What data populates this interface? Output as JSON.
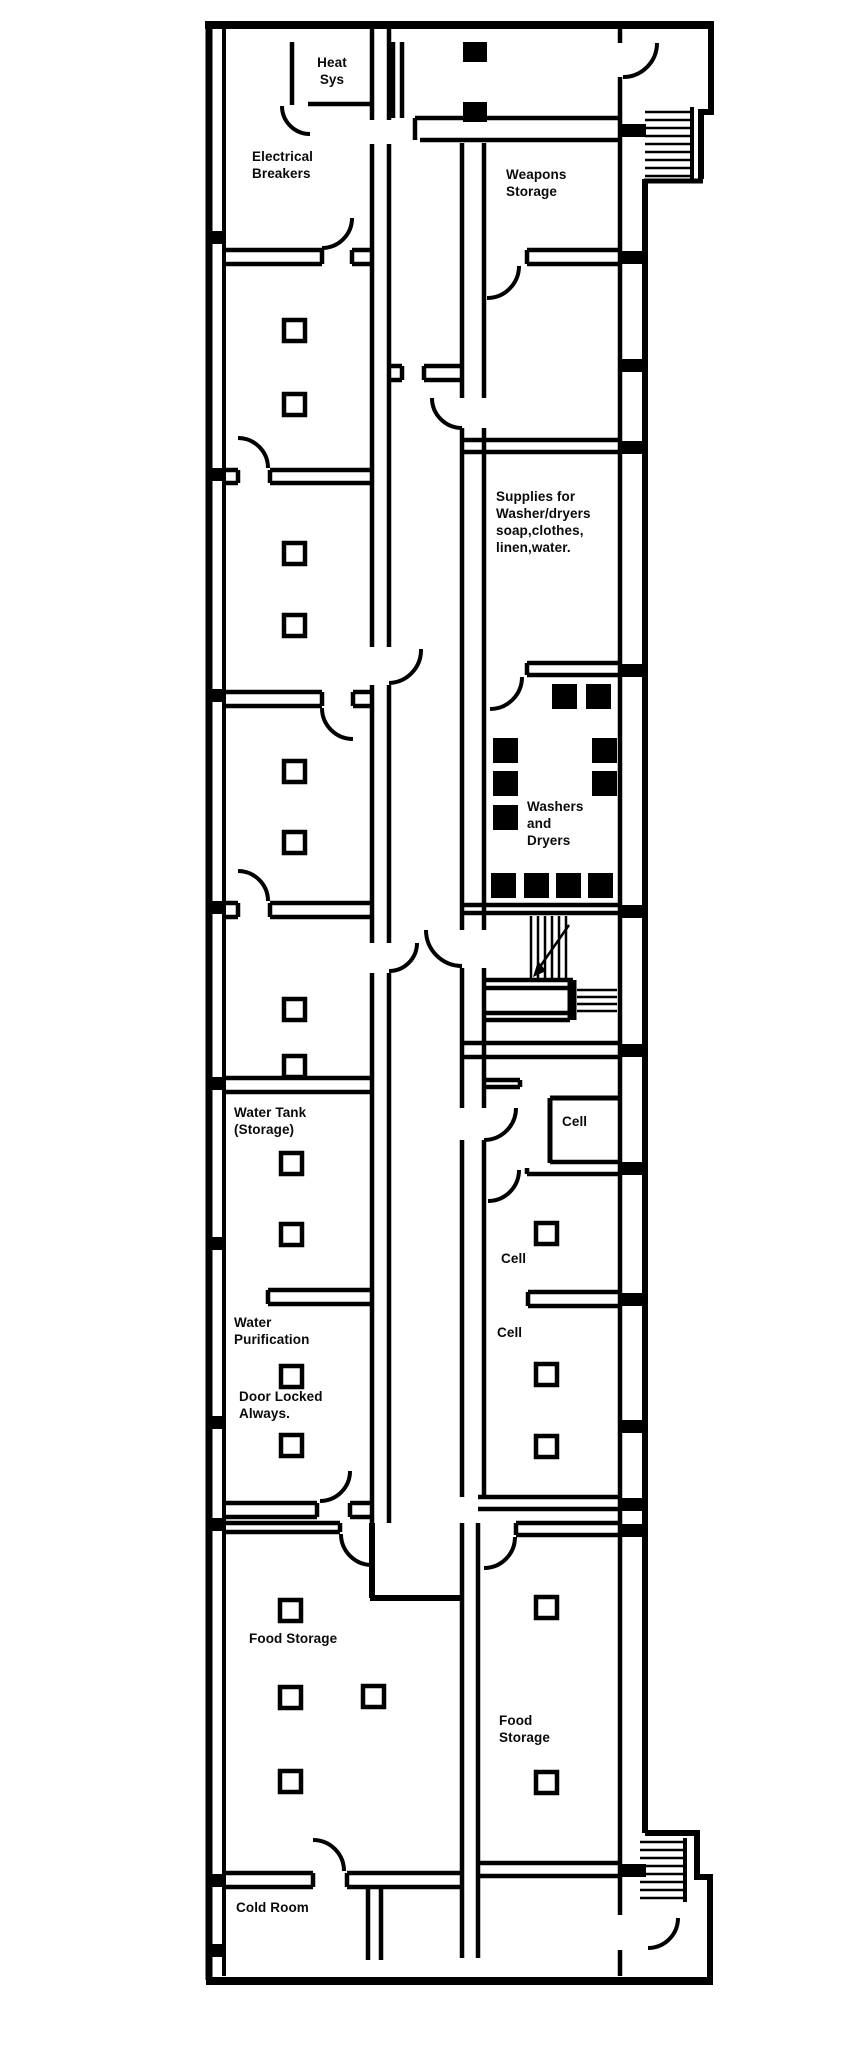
{
  "document": {
    "type": "building floor plan (scanned black-and-white drawing)"
  },
  "rooms": {
    "heat_sys": {
      "label": "Heat\nSys"
    },
    "electrical_breakers": {
      "label": "Electrical\nBreakers"
    },
    "weapons_storage": {
      "label": "Weapons\nStorage"
    },
    "supplies": {
      "label": "Supplies for\nWasher/dryers\nsoap,clothes,\nlinen,water."
    },
    "washers_dryers": {
      "label": "Washers\nand\nDryers"
    },
    "water_tank": {
      "label": "Water Tank\n(Storage)"
    },
    "cell_top": {
      "label": "Cell"
    },
    "cell_middle": {
      "label": "Cell"
    },
    "cell_lower": {
      "label": "Cell"
    },
    "water_purification": {
      "label": "Water\nPurification"
    },
    "water_purification_note": {
      "label": "Door Locked\nAlways."
    },
    "food_storage_left": {
      "label": "Food Storage"
    },
    "food_storage_right": {
      "label": "Food\nStorage"
    },
    "cold_room": {
      "label": "Cold Room"
    }
  },
  "icons": {
    "staircase_top_right": "stairs-icon",
    "staircase_central": "stairs-icon",
    "staircase_bottom_right": "stairs-icon",
    "door_arcs": "door-swing-icon",
    "pillars": "column-icon",
    "appliance_blocks": "washer-dryer-icon"
  },
  "colors": {
    "wall": "#000000",
    "background": "#ffffff",
    "appliance_fill": "#000000",
    "text": "#0a0a0a"
  }
}
